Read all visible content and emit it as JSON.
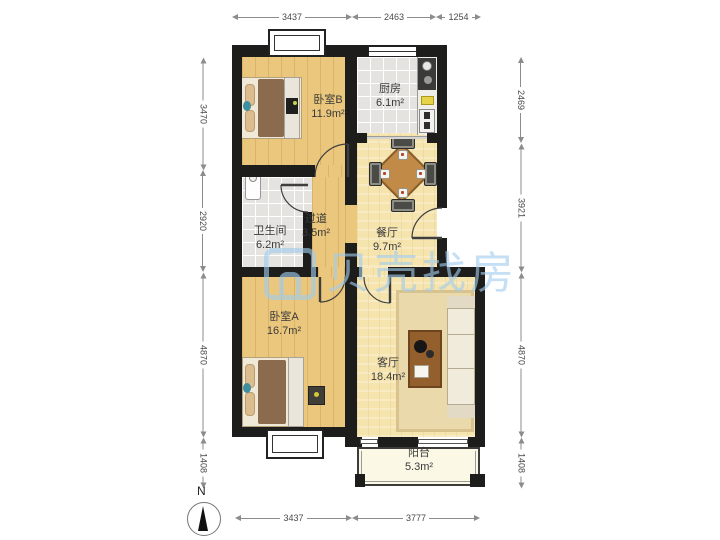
{
  "watermark": {
    "text": "贝壳找房"
  },
  "compass": {
    "north_label": "N"
  },
  "rooms": [
    {
      "id": "bedroom-b",
      "name": "卧室B",
      "area": "11.9m²"
    },
    {
      "id": "kitchen",
      "name": "厨房",
      "area": "6.1m²"
    },
    {
      "id": "bathroom",
      "name": "卫生间",
      "area": "6.2m²"
    },
    {
      "id": "hallway",
      "name": "过道",
      "area": "3.5m²"
    },
    {
      "id": "dining",
      "name": "餐厅",
      "area": "9.7m²"
    },
    {
      "id": "bedroom-a",
      "name": "卧室A",
      "area": "16.7m²"
    },
    {
      "id": "living",
      "name": "客厅",
      "area": "18.4m²"
    },
    {
      "id": "balcony",
      "name": "阳台",
      "area": "5.3m²"
    }
  ],
  "dims": {
    "top": [
      "3437",
      "2463",
      "1254"
    ],
    "bottom": [
      "3437",
      "3777"
    ],
    "left": [
      "3470",
      "2920",
      "4870",
      "1408"
    ],
    "right": [
      "2469",
      "3921",
      "4870",
      "1408"
    ]
  },
  "colors": {
    "wall": "#1d1d1c",
    "wood_floor": "#eac77c",
    "light_wood_floor": "#f6e4af",
    "tile_floor": "#e4e3df",
    "balcony_floor": "#fbf8e6",
    "watermark_blue": "#a2ccee"
  }
}
